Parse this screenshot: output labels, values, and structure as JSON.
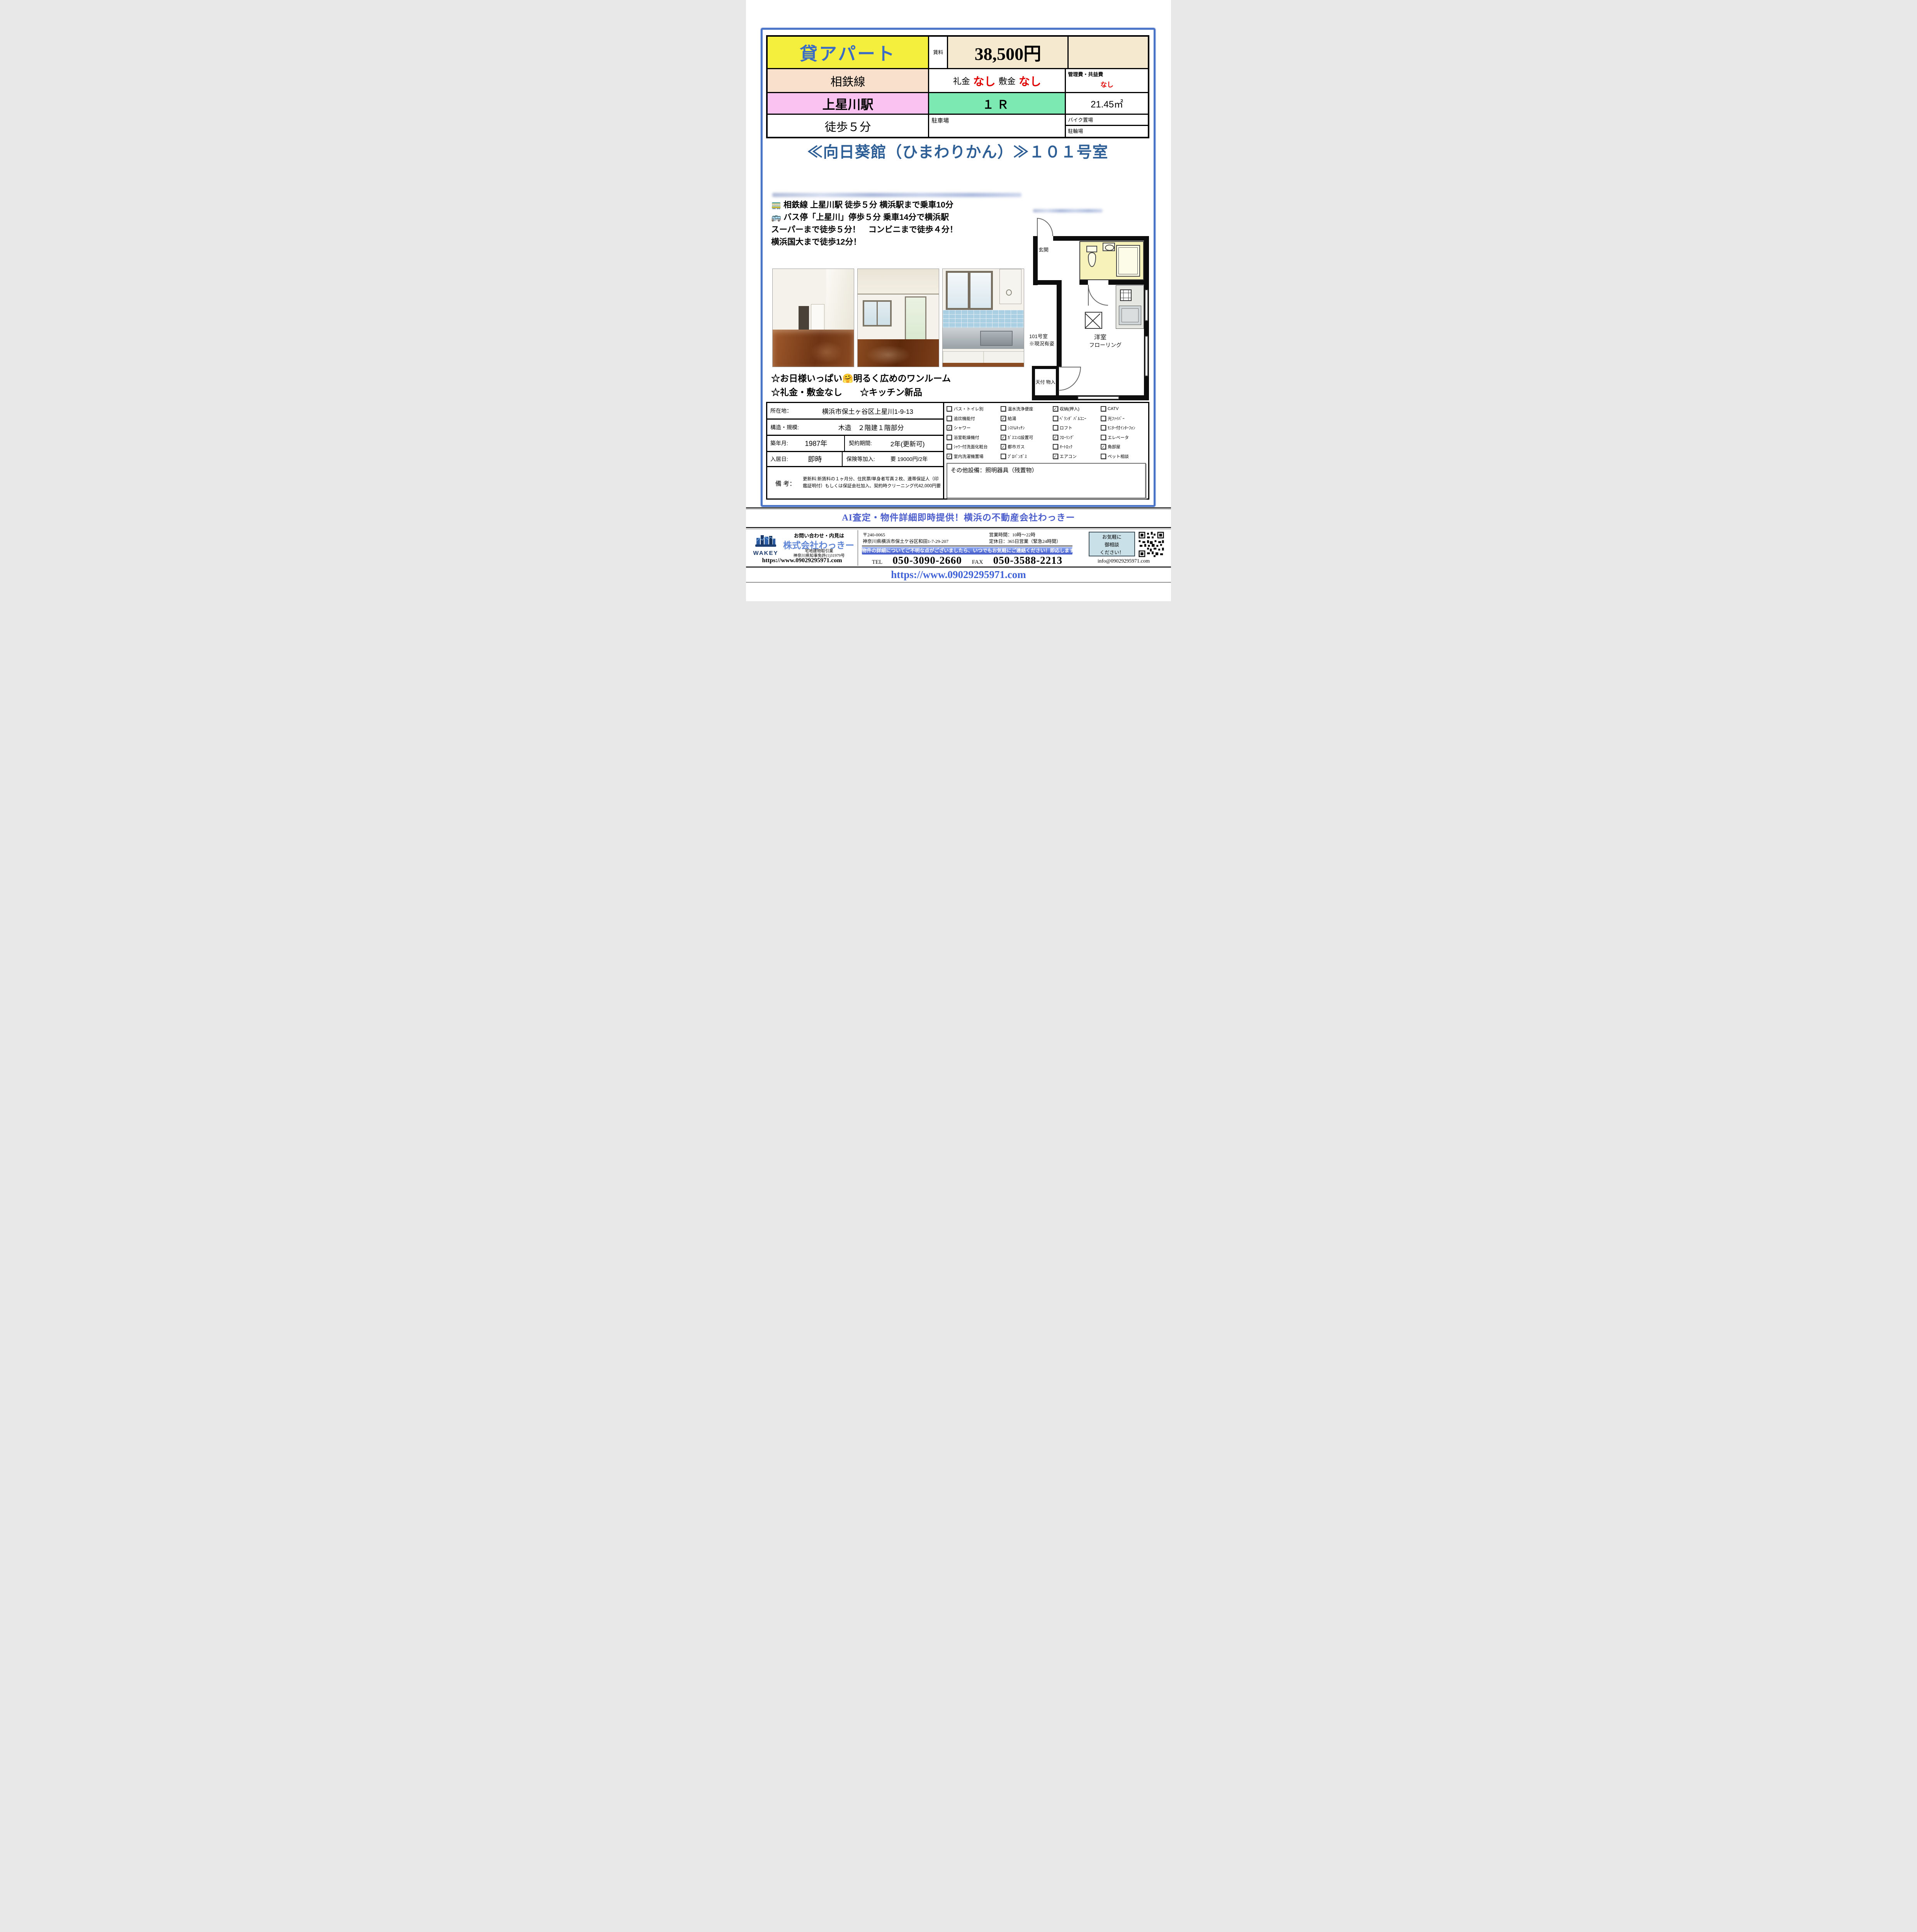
{
  "header": {
    "type_label": "貸アパート",
    "rent_label": "賃料",
    "rent_value": "38,500円",
    "line_name": "相鉄線",
    "reikin_label": "礼金",
    "reikin_value": "なし",
    "shikikin_label": "敷金",
    "shikikin_value": "なし",
    "mgmt_label": "管理費・共益費",
    "mgmt_value": "なし",
    "station": "上星川駅",
    "madori": "１Ｒ",
    "area": "21.45㎡",
    "walk": "徒歩５分",
    "parking_label": "駐車場",
    "bike_label": "バイク置場",
    "bicycle_label": "駐輪場"
  },
  "title_banner": "≪向日葵館（ひまわりかん）≫１０１号室",
  "access_lines": [
    "🚃 相鉄線 上星川駅 徒歩５分 横浜駅まで乗車10分",
    "🚌 バス停「上星川」停歩５分 乗車14分で横浜駅",
    "スーパーまで徒歩５分！　コンビニまで徒歩４分！",
    "横浜国大まで徒歩12分！"
  ],
  "highlights": [
    "☆お日様いっぱい🤗明るく広めのワンルーム",
    "☆礼金・敷金なし　　☆キッチン新品"
  ],
  "floorplan": {
    "entrance": "玄関",
    "room_line1": "洋室",
    "room_line2": "フローリング",
    "closet": "天付\n物入",
    "caption": "101号室\n※現況有姿"
  },
  "details": {
    "location_label": "所在地：",
    "location_value": "横浜市保土ヶ谷区上星川1-9-13",
    "structure_label": "構造・規模:",
    "structure_value": "木造　２階建１階部分",
    "built_label": "築年月:",
    "built_value": "1987年",
    "contract_label": "契約期間:",
    "contract_value": "2年(更新可)",
    "movein_label": "入居日:",
    "movein_value": "即時",
    "insurance_label": "保険等加入:",
    "insurance_value": "要 19000円/2年",
    "remarks_label": "備 考：",
    "remarks_value": "更新料:新賃料の１ヶ月分、住民票/単身者写真２枚、連帯保証人（印鑑証明付）もしくは保証会社加入、契約時クリーニング代42,000円要"
  },
  "amenities": [
    {
      "label": "バス・トイレ別",
      "checked": false
    },
    {
      "label": "温水洗浄便座",
      "checked": false
    },
    {
      "label": "収納(押入)",
      "checked": true
    },
    {
      "label": "CATV",
      "checked": false
    },
    {
      "label": "追炊機能付",
      "checked": false
    },
    {
      "label": "給湯",
      "checked": true
    },
    {
      "label": "ﾍﾞﾗﾝﾀﾞ ﾊﾞﾙｺﾆｰ",
      "checked": false
    },
    {
      "label": "光ﾌｧｲﾊﾞｰ",
      "checked": false
    },
    {
      "label": "シャワー",
      "checked": true
    },
    {
      "label": "ｼｽﾃﾑｷｯﾁﾝ",
      "checked": false
    },
    {
      "label": "ロフト",
      "checked": false
    },
    {
      "label": "ﾓﾆﾀｰ付ｲﾝﾀｰﾌｫﾝ",
      "checked": false
    },
    {
      "label": "浴室乾燥機付",
      "checked": false
    },
    {
      "label": "ｶﾞｽｺﾝﾛ設置可",
      "checked": true
    },
    {
      "label": "ﾌﾛｰﾘﾝｸﾞ",
      "checked": true
    },
    {
      "label": "エレベータ",
      "checked": false
    },
    {
      "label": "ｼｬﾜｰ付洗面化粧台",
      "checked": false
    },
    {
      "label": "都市ガス",
      "checked": true
    },
    {
      "label": "ｵｰﾄﾛｯｸ",
      "checked": false
    },
    {
      "label": "角部屋",
      "checked": true
    },
    {
      "label": "室内洗濯機置場",
      "checked": true
    },
    {
      "label": "ﾌﾟﾛﾊﾟﾝｶﾞｽ",
      "checked": false
    },
    {
      "label": "エアコン",
      "checked": true
    },
    {
      "label": "ペット相談",
      "checked": false
    }
  ],
  "other_equipment": "その他設備：照明器具（残置物）",
  "ai_banner": "AI査定・物件詳細即時提供！横浜の不動産会社わっきー",
  "footer": {
    "inquiry": "お問い合わせ・内見は",
    "company": "株式会社わっきー",
    "license1": "宅地建物取引業",
    "license2": "神奈川県知事免許(1)31979号",
    "site_left": "https://www.09029295971.com",
    "postal": "〒240-0065",
    "address": "神奈川県横浜市保土ケ谷区和田1-7-29-207",
    "hours": "営業時間：10時～22時",
    "holiday": "定休日：365日営業（緊急24時間）",
    "notice": "物件の詳細についてご不明な点がございましたら、いつでもお気軽にご連絡ください！即応します！",
    "tel_label": "TEL",
    "tel": "050-3090-2660",
    "fax_label": "FAX",
    "fax": "050-3588-2213",
    "consult": "お気軽に\n御相談\nください！",
    "email": "info@09029295971.com",
    "logo": "WAKEY"
  },
  "bottom_url": "https://www.09029295971.com"
}
